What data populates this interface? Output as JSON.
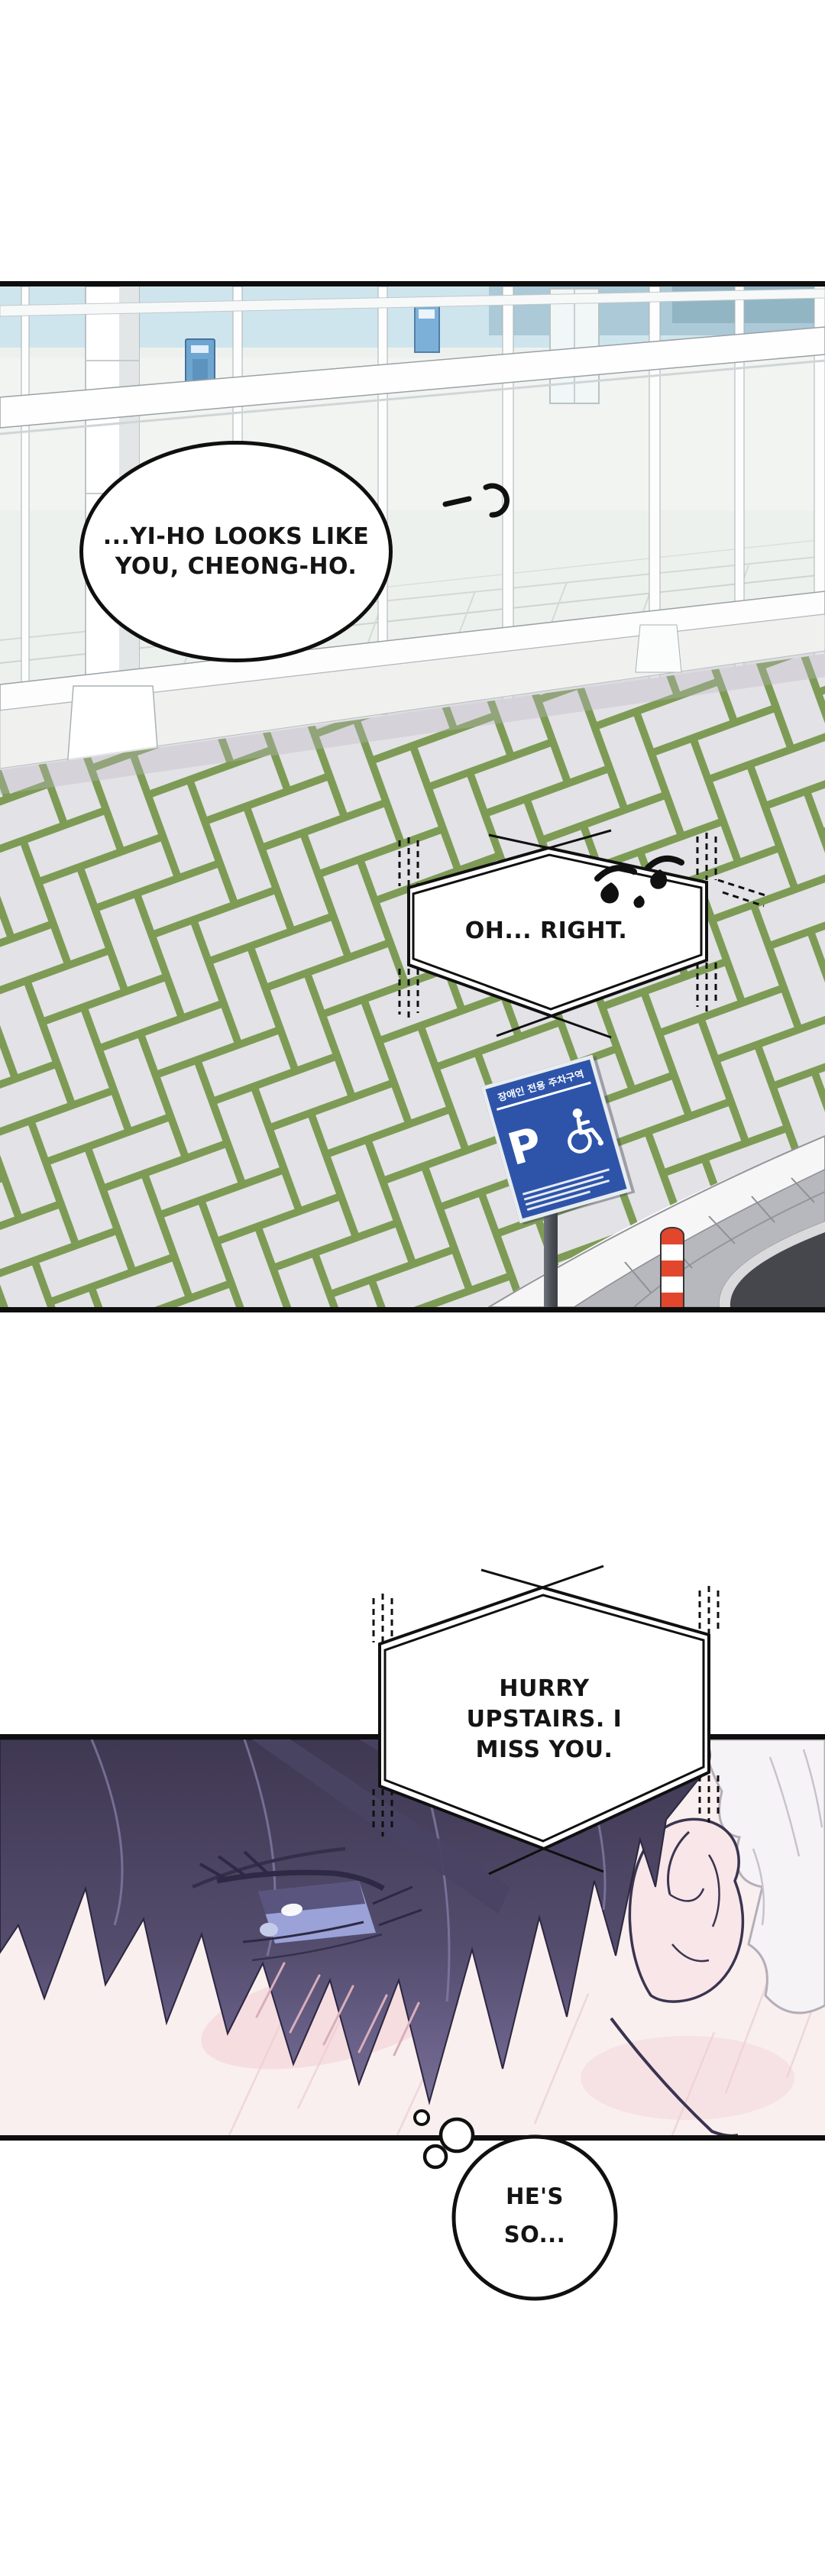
{
  "panel_exterior": {
    "speech_bubble": {
      "line1": "...YI-HO",
      "line2": "LOOKS LIKE YOU,",
      "line3": "CHEONG-HO."
    },
    "phone_bubble": {
      "text": "OH... RIGHT."
    },
    "parking_sign": {
      "title": "장애인 전용 주차구역",
      "letter": "P"
    }
  },
  "panel_closeup": {
    "phone_bubble": {
      "line1": "HURRY",
      "line2": "UPSTAIRS. I",
      "line3": "MISS YOU."
    }
  },
  "thought_bubble": {
    "line1": "HE'S",
    "line2": "SO..."
  },
  "icons": {
    "wheelchair": "♿"
  },
  "colors": {
    "sign_blue": "#2e54aa",
    "bollard_red": "#e2472e",
    "grass_green": "#7d9b55",
    "paver_gray": "#e3e2e6",
    "hair_purple": "#4a4363",
    "road_asphalt": "#46474d"
  }
}
